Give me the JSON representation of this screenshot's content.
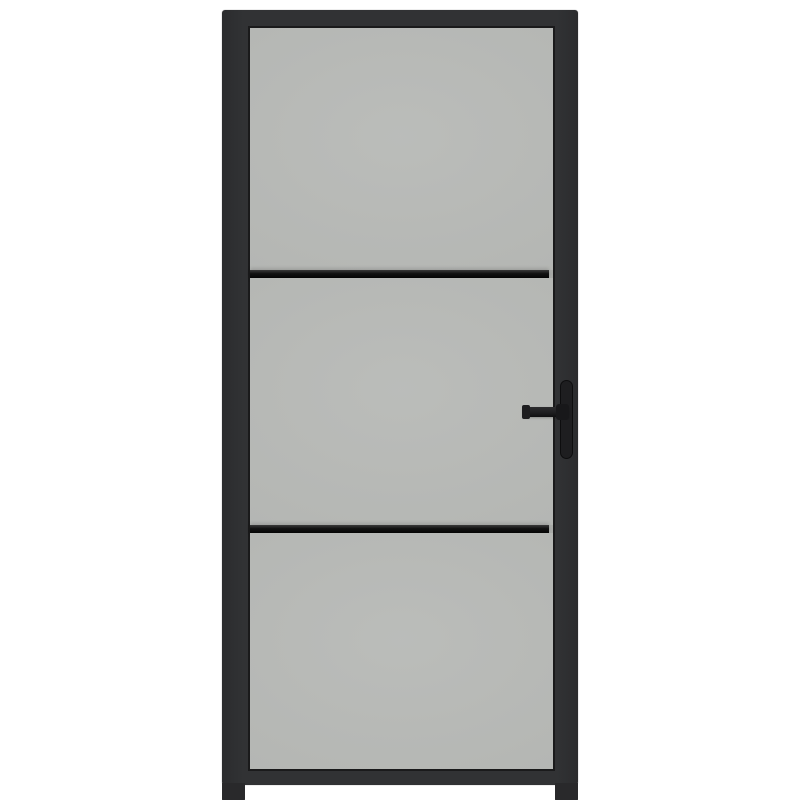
{
  "scene": {
    "description": "Front-view product photo of an interior door: black metal frame, three frosted glass panels separated by two horizontal glazing bars, black lever handle with vertical backplate on the right stile, small stile feet below the bottom rail, on a plain white background.",
    "background": "#ffffff"
  },
  "colors": {
    "background": "#ffffff",
    "frame": "#313234",
    "frameEdge": "#1a1a1b",
    "glass": "#b7b9b6",
    "bar": "#111111",
    "handle": "#1e1e20",
    "foot": "#29292b"
  },
  "door": {
    "panel_count": 3,
    "glazing_bar_count": 2,
    "handle_side": "right",
    "labels": {
      "door": "interior glass door with black frame",
      "frame": "black door frame",
      "glass": "frosted glass panel",
      "pane_top": "top glass pane",
      "pane_middle": "middle glass pane",
      "pane_bottom": "bottom glass pane",
      "bar_upper": "upper horizontal glazing bar",
      "bar_lower": "lower horizontal glazing bar",
      "handle": "black lever door handle",
      "backplate": "handle backplate",
      "lever": "handle lever",
      "foot_left": "left stile foot",
      "foot_right": "right stile foot"
    }
  }
}
